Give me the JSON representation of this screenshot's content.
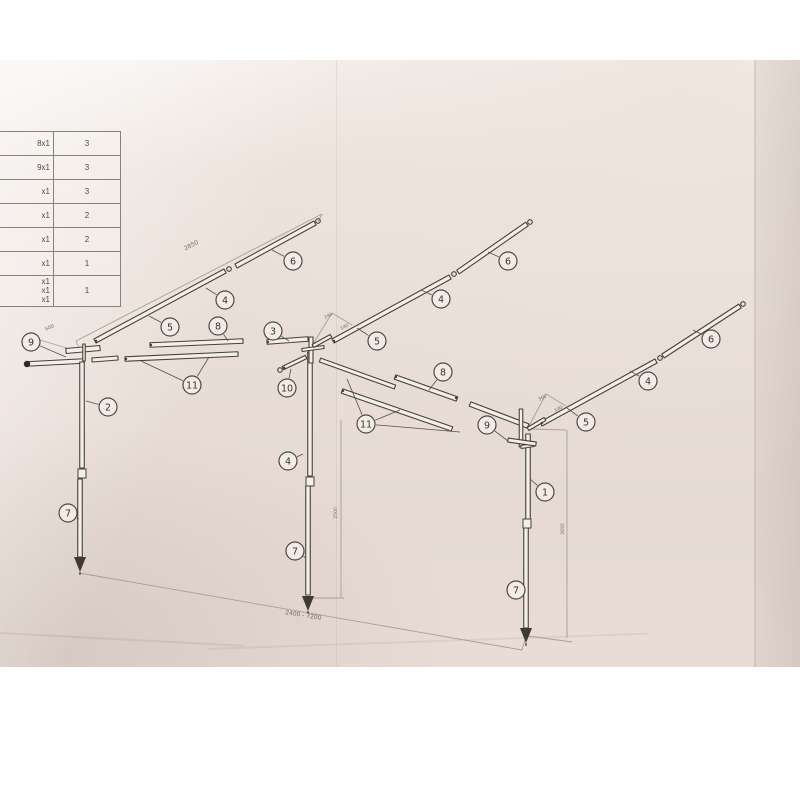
{
  "photo": {
    "paper_color": "#e9ded7",
    "line_color": "#474139",
    "dim_color": "#a59c93"
  },
  "parts_table": {
    "rows": [
      {
        "desc": "8x1",
        "qty": "3"
      },
      {
        "desc": "9x1",
        "qty": "3"
      },
      {
        "desc": "x1",
        "qty": "3"
      },
      {
        "desc": "x1",
        "qty": "2"
      },
      {
        "desc": "x1",
        "qty": "2"
      },
      {
        "desc": "x1",
        "qty": "1"
      },
      {
        "desc": "x1 x1 x1",
        "qty": "1"
      }
    ]
  },
  "callouts": [
    {
      "label": "6",
      "x": 293,
      "y": 261,
      "targets": [
        [
          272,
          250
        ]
      ]
    },
    {
      "label": "4",
      "x": 225,
      "y": 300,
      "targets": [
        [
          206,
          288
        ]
      ]
    },
    {
      "label": "5",
      "x": 170,
      "y": 327,
      "targets": [
        [
          149,
          316
        ]
      ]
    },
    {
      "label": "8",
      "x": 218,
      "y": 326,
      "targets": [
        [
          228,
          341
        ]
      ]
    },
    {
      "label": "3",
      "x": 273,
      "y": 331,
      "targets": [
        [
          289,
          341
        ]
      ]
    },
    {
      "label": "9",
      "x": 31,
      "y": 342,
      "targets": [
        [
          66,
          357
        ]
      ]
    },
    {
      "label": "2",
      "x": 108,
      "y": 407,
      "targets": [
        [
          86,
          401
        ]
      ]
    },
    {
      "label": "7",
      "x": 68,
      "y": 513,
      "targets": [
        [
          79,
          519
        ]
      ]
    },
    {
      "label": "11",
      "x": 192,
      "y": 385,
      "targets": [
        [
          141,
          361
        ],
        [
          209,
          357
        ]
      ]
    },
    {
      "label": "10",
      "x": 287,
      "y": 388,
      "targets": [
        [
          291,
          369
        ]
      ]
    },
    {
      "label": "6",
      "x": 508,
      "y": 261,
      "targets": [
        [
          488,
          252
        ]
      ]
    },
    {
      "label": "4",
      "x": 441,
      "y": 299,
      "targets": [
        [
          421,
          290
        ]
      ]
    },
    {
      "label": "5",
      "x": 377,
      "y": 341,
      "targets": [
        [
          357,
          328
        ]
      ]
    },
    {
      "label": "8",
      "x": 443,
      "y": 372,
      "targets": [
        [
          429,
          390
        ]
      ]
    },
    {
      "label": "11",
      "x": 366,
      "y": 424,
      "targets": [
        [
          347,
          379
        ],
        [
          400,
          410
        ],
        [
          460,
          432
        ]
      ]
    },
    {
      "label": "4",
      "x": 288,
      "y": 461,
      "targets": [
        [
          303,
          454
        ]
      ]
    },
    {
      "label": "7",
      "x": 295,
      "y": 551,
      "targets": [
        [
          306,
          558
        ]
      ]
    },
    {
      "label": "9",
      "x": 487,
      "y": 425,
      "targets": [
        [
          508,
          441
        ]
      ]
    },
    {
      "label": "1",
      "x": 545,
      "y": 492,
      "targets": [
        [
          530,
          479
        ]
      ]
    },
    {
      "label": "7",
      "x": 516,
      "y": 590,
      "targets": [
        [
          524,
          597
        ]
      ]
    },
    {
      "label": "6",
      "x": 711,
      "y": 339,
      "targets": [
        [
          693,
          330
        ]
      ]
    },
    {
      "label": "4",
      "x": 648,
      "y": 381,
      "targets": [
        [
          630,
          371
        ]
      ]
    },
    {
      "label": "5",
      "x": 586,
      "y": 422,
      "targets": [
        [
          567,
          408
        ]
      ]
    }
  ],
  "dimensions": [
    {
      "text": "2850",
      "x": 192,
      "y": 247,
      "rot": -27,
      "size": 6
    },
    {
      "text": "500",
      "x": 50,
      "y": 329,
      "rot": -24,
      "size": 5
    },
    {
      "text": "240",
      "x": 329,
      "y": 317,
      "rot": -27,
      "size": 4.5
    },
    {
      "text": "140",
      "x": 345,
      "y": 328,
      "rot": -27,
      "size": 4.5
    },
    {
      "text": "360",
      "x": 543,
      "y": 399,
      "rot": -27,
      "size": 4.5
    },
    {
      "text": "140",
      "x": 559,
      "y": 410,
      "rot": -27,
      "size": 4.5
    },
    {
      "text": "2400 - 7200",
      "x": 303,
      "y": 617,
      "rot": 9,
      "size": 6
    },
    {
      "text": "2500",
      "x": 337,
      "y": 513,
      "rot": -90,
      "size": 4.5
    },
    {
      "text": "2650",
      "x": 564,
      "y": 529,
      "rot": -90,
      "size": 4.5
    }
  ]
}
